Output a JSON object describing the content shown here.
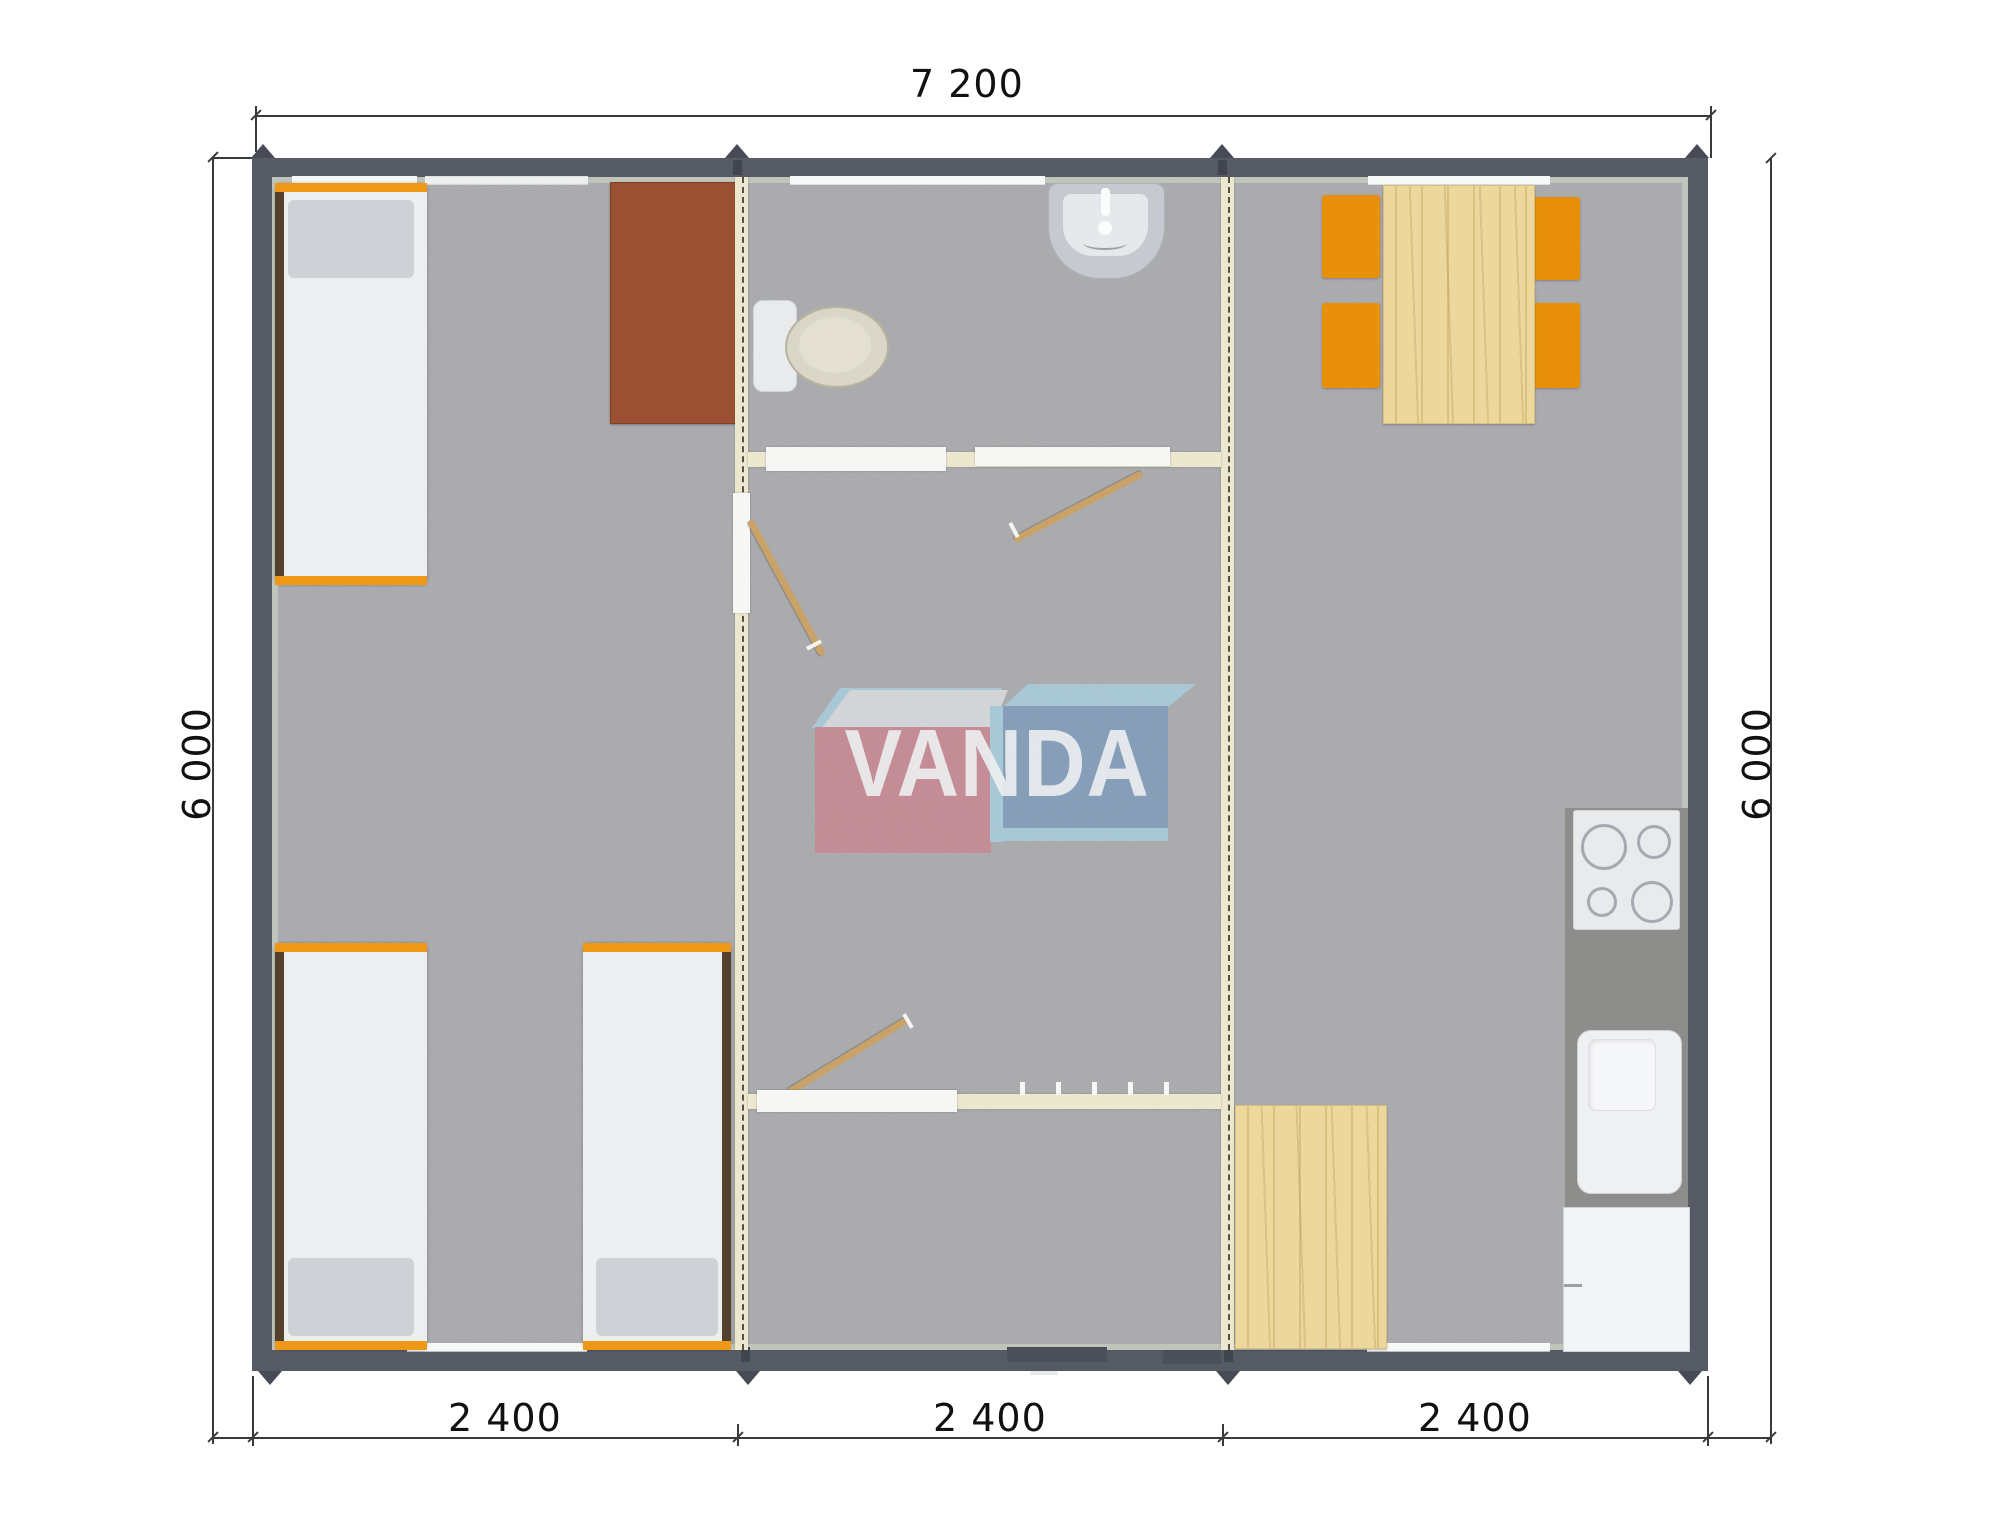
{
  "document": {
    "kind": "modular-house-floor-plan",
    "view": "top-down"
  },
  "dimensions": {
    "top": "7 200",
    "left": "6 000",
    "right": "6 000",
    "bottom": [
      "2 400",
      "2 400",
      "2 400"
    ]
  },
  "watermark": {
    "text": "VANDA"
  },
  "furniture": [
    "bed",
    "bed",
    "bed",
    "desk",
    "toilet",
    "wash-basin",
    "dining-table",
    "chair",
    "chair",
    "chair",
    "chair",
    "cooktop",
    "kitchen-sink",
    "fridge",
    "wood-mat",
    "kitchen-counter"
  ],
  "colors": {
    "outer_wall": "#565a64",
    "inner_wall_band": "#c0c5bc",
    "floor": "#a8a9ac",
    "partition": "#ece7cf",
    "partition_dash": "#55504a",
    "accent_orange": "#e8900a",
    "wood": "#ecd79c",
    "desk_brown": "#9b5033",
    "bed_white": "#eceef0",
    "pillow_gray": "#ced2d6",
    "bed_rail_brown": "#54402c",
    "counter_gray": "#8d8d8b",
    "logo_red": "#ca8791",
    "logo_blue": "#7f9cba",
    "logo_lightblue": "#a9cfdf",
    "logo_white_face": "#dcdee1",
    "dimension_line": "#3a3a3a"
  }
}
